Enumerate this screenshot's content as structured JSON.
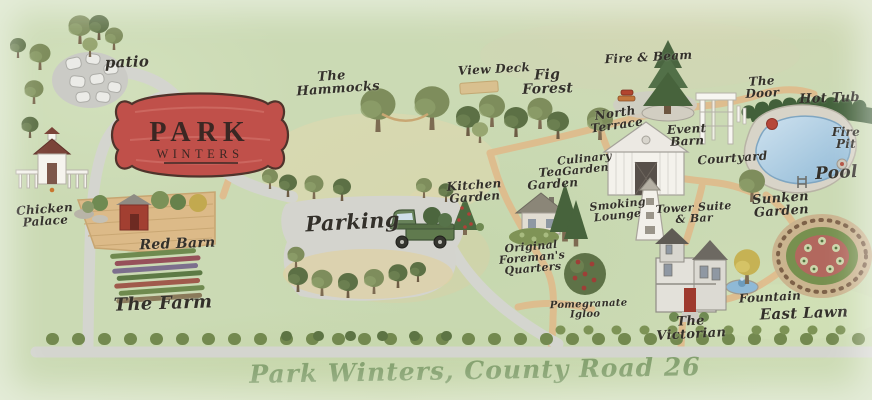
{
  "map_title": "Park Winters illustrated property map",
  "sign": {
    "line1": "PARK",
    "line2": "WINTERS"
  },
  "caption": "Park Winters, County Road 26",
  "labels": {
    "patio": "patio",
    "hammocks": "The Hammocks",
    "view_deck": "View Deck",
    "fig_forest": "Fig Forest",
    "fire_beam": "Fire & Beam",
    "north_terrace": "North Terrace",
    "the_door": "The Door",
    "hot_tub": "Hot Tub",
    "fire_pit": "Fire Pit",
    "pool": "Pool",
    "event_barn": "Event Barn",
    "courtyard": "Courtyard",
    "culinary_garden": "Culinary Garden",
    "tea_garden": "Tea Garden",
    "kitchen_garden": "Kitchen Garden",
    "parking": "Parking",
    "foremans_quarters": "Original Foreman's Quarters",
    "smoking_lounge": "Smoking Lounge",
    "tower_suite": "Tower Suite & Bar",
    "chicken_palace": "Chicken Palace",
    "red_barn": "Red Barn",
    "the_farm": "The Farm",
    "pomegranate_igloo": "Pomegranate Igloo",
    "victorian": "The Victorian",
    "fountain": "Fountain",
    "east_lawn": "East Lawn",
    "sunken_garden": "Sunken Garden"
  },
  "colors": {
    "grass_green": "#cbdab4",
    "sign_red": "#c0504a",
    "sign_ink": "#3b2723",
    "label_ink": "#33302a",
    "caption_green": "#83a06d",
    "road_grey": "#d4d5cf",
    "path_tan": "#dfbc8d",
    "pool_blue": "#9fc3dc",
    "hedge_green": "#42603a",
    "barn_red": "#a23f31"
  }
}
